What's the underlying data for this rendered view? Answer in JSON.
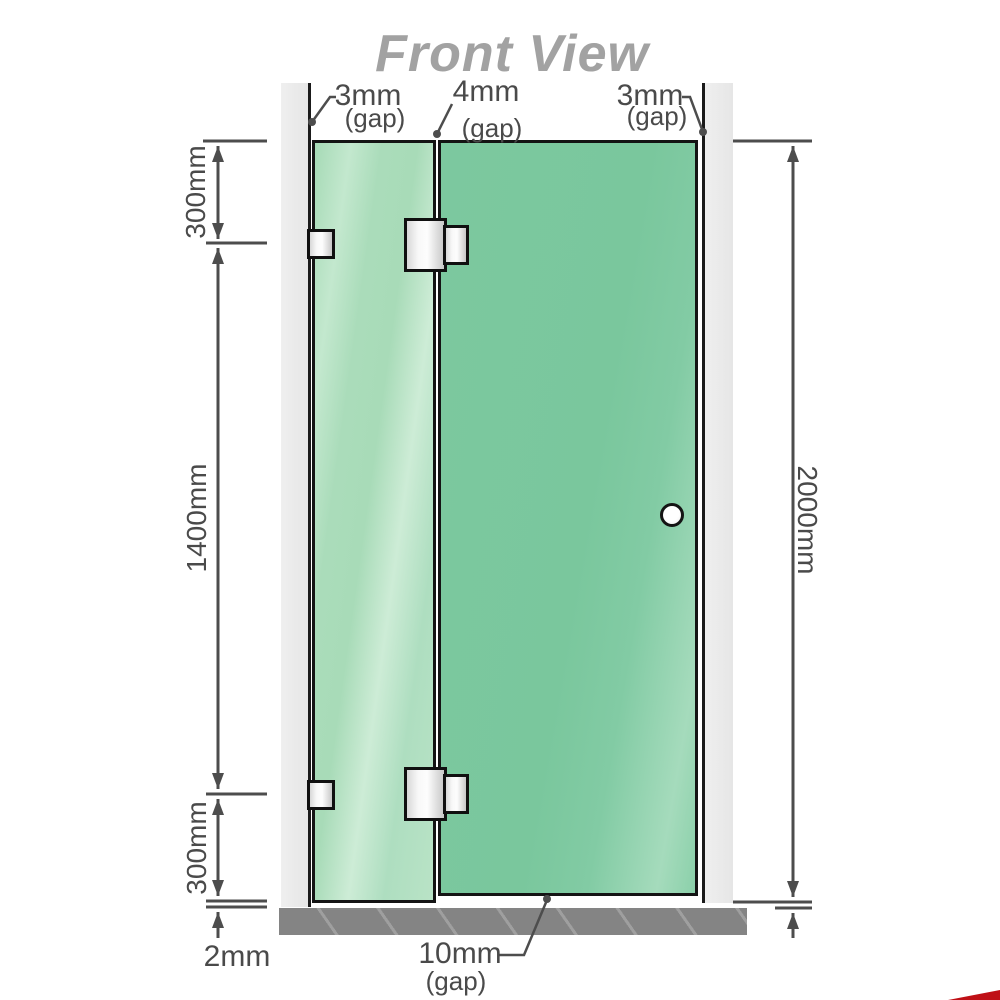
{
  "title": "Front View",
  "annotations": {
    "gap_top_left": {
      "value": "3mm",
      "label": "(gap)"
    },
    "gap_top_middle": {
      "value": "4mm",
      "label": "(gap)"
    },
    "gap_top_right": {
      "value": "3mm",
      "label": "(gap)"
    },
    "gap_bottom": {
      "value": "10mm",
      "label": "(gap)"
    },
    "dim_left_top": "300mm",
    "dim_left_middle": "1400mm",
    "dim_left_bottom": "300mm",
    "dim_bottom_left": "2mm",
    "dim_right": "2000mm"
  },
  "colors": {
    "glass_fixed_panel": "#aedec0",
    "glass_door_panel": "#7cc89f",
    "wall": "#e9e9e9",
    "floor": "#848484",
    "dimension_line": "#4d4d4d",
    "title_gray": "#a2a2a2",
    "corner_accent_red": "#bf1016"
  }
}
